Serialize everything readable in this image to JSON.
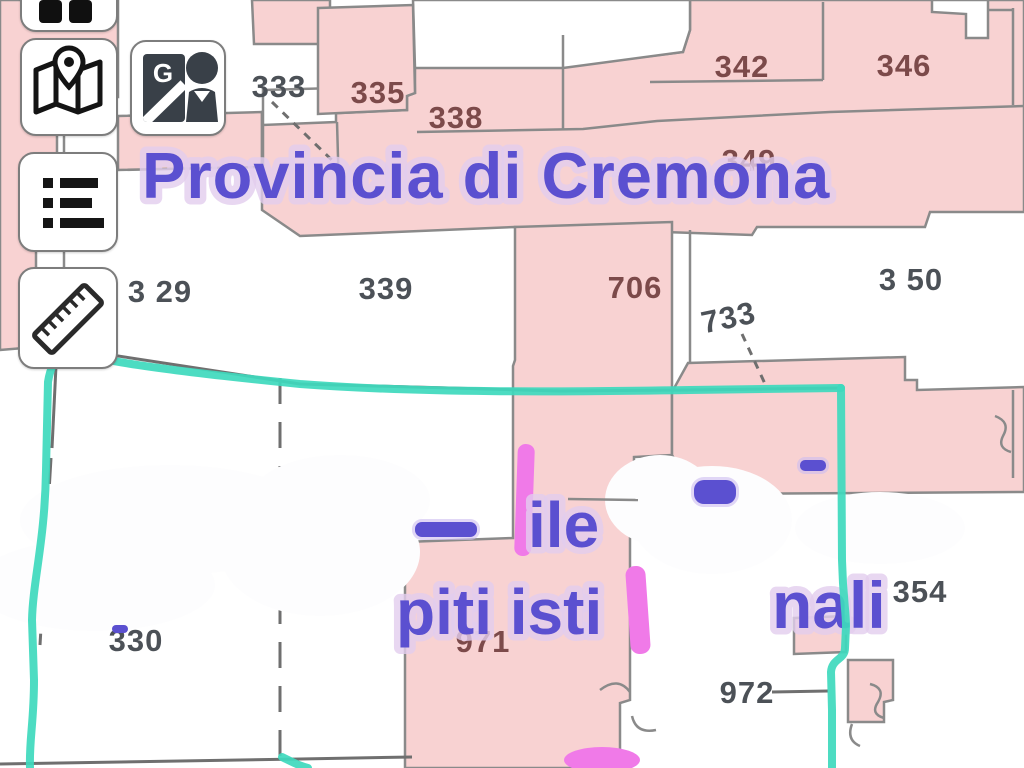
{
  "map": {
    "title": "Provincia di Cremona",
    "watermark": {
      "line1_fragment": "ile",
      "line2_left_fragment": "piti isti",
      "line2_right_fragment": "nali"
    },
    "labels": {
      "p333": {
        "text": "333"
      },
      "p335": {
        "text": "335"
      },
      "p338": {
        "text": "338"
      },
      "p342": {
        "text": "342"
      },
      "p346": {
        "text": "346"
      },
      "p349": {
        "text": "349"
      },
      "p329": {
        "text": "3 29"
      },
      "p339": {
        "text": "339"
      },
      "p706": {
        "text": "706"
      },
      "p733": {
        "text": "733"
      },
      "p350": {
        "text": "3 50"
      },
      "p330": {
        "text": "330"
      },
      "p971": {
        "text": "971"
      },
      "p972": {
        "text": "972"
      },
      "p354": {
        "text": "354"
      }
    }
  },
  "toolbar": {
    "buttons": [
      {
        "id": "layers",
        "icon": "grid-squares-icon"
      },
      {
        "id": "map-locator",
        "icon": "map-pin-icon"
      },
      {
        "id": "street-view",
        "icon": "google-pegman-icon",
        "letter": "G"
      },
      {
        "id": "legend",
        "icon": "list-icon"
      },
      {
        "id": "measure",
        "icon": "ruler-icon"
      }
    ]
  },
  "colors": {
    "parcel_pink": "#f8d2d2",
    "boundary_gray": "#8a8a8a",
    "label_gray": "#4c5157",
    "label_maroon": "#7c4a4a",
    "highlight_teal": "#3ed9bd",
    "watermark_purple": "#5b50d0",
    "watermark_glow": "#e2cdee",
    "magenta_mark": "#f07ae8",
    "icon_dark": "#394048"
  }
}
